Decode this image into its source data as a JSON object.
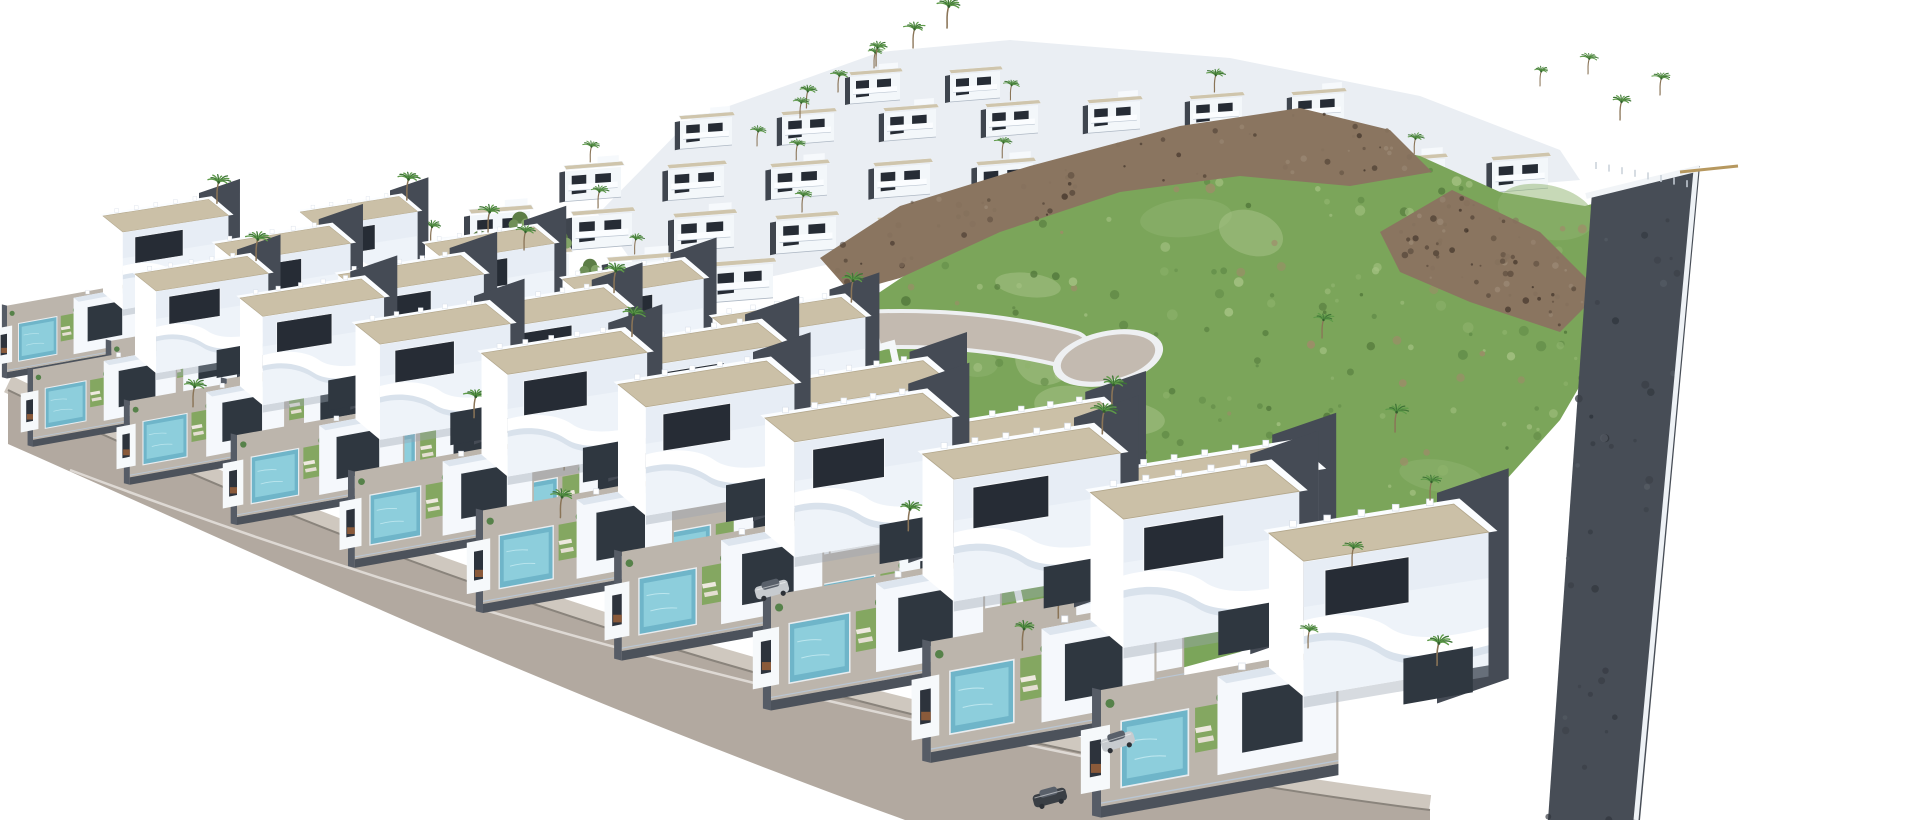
{
  "scene": {
    "description": "Aerial 3D render of a modern white villa resort development built on a slope: diagonal rows of cubic white villas with curved balconies, gravel flat roofs, private pools and palm trees; a dense cluster of terraced houses at the top; a green hillside with brown rocky outcrops on the right; a wide curved access road with sidewalk at the bottom left; no text visible in the image.",
    "seed": 11,
    "colors": {
      "background": "#ffffff",
      "villa_white": "#ffffff",
      "villa_face": "#eef3f9",
      "villa_face2": "#dde6f0",
      "villa_shade": "#c9d4e2",
      "roof_gravel": "#cbc0a7",
      "roof_edge": "#b3a78c",
      "window_dark": "#262c35",
      "glass_dark": "#2f3740",
      "terrace": "#bcb5ac",
      "pool": "#6fb5c9",
      "pool_light": "#93d2df",
      "lawn": "#84a761",
      "dark_wall": "#454b55",
      "fence_wall": "#565c66",
      "underlay": "#eaeef3",
      "hill_green": "#7ba55a",
      "hill_dark": "#53793c",
      "hill_light": "#a5c283",
      "soil": "#a08a6a",
      "rock_brown": "#8a7560",
      "rock_dark": "#5a4a3c",
      "rock_light": "#9c8a76",
      "palm_green": "#3e7436",
      "palm_green2": "#5d9a48",
      "trunk": "#8a7457",
      "tree_olive": "#6f8f57",
      "road": "#b2a9a0",
      "sidewalk": "#cfc8bf",
      "curb_line": "#8a847c",
      "white_line": "#eceae5",
      "inner_road": "#c3bab0",
      "inner_curb": "#eef0f2",
      "strip_dark": "#474d56",
      "car_silver": "#c7cbcf",
      "car_dark": "#3a3f45",
      "planter_orange": "#8a5a3a"
    },
    "road": {
      "top_path": "M8,390 C400,580 900,745 1430,810",
      "polygon": "M8,390 C400,580 900,745 1430,810 L1430,820 L905,820 C520,680 260,555 8,444 Z",
      "white_line": "M70,470 C480,625 800,700 1160,772"
    },
    "inner_road": {
      "path": "M862,330 C940,326 1010,334 1072,350",
      "bulb": [
        1108,
        358,
        56,
        27,
        -12
      ]
    },
    "hill": [
      [
        865,
        302
      ],
      [
        940,
        252
      ],
      [
        1060,
        200
      ],
      [
        1200,
        158
      ],
      [
        1330,
        136
      ],
      [
        1420,
        156
      ],
      [
        1500,
        192
      ],
      [
        1585,
        206
      ],
      [
        1668,
        182
      ],
      [
        1640,
        282
      ],
      [
        1560,
        420
      ],
      [
        1470,
        520
      ],
      [
        1360,
        592
      ],
      [
        1240,
        652
      ],
      [
        1130,
        682
      ],
      [
        1040,
        666
      ],
      [
        952,
        592
      ],
      [
        892,
        472
      ],
      [
        864,
        382
      ]
    ],
    "rocks": [
      [
        [
          820,
          258
        ],
        [
          900,
          206
        ],
        [
          1030,
          166
        ],
        [
          1180,
          126
        ],
        [
          1300,
          108
        ],
        [
          1390,
          130
        ],
        [
          1432,
          172
        ],
        [
          1350,
          186
        ],
        [
          1240,
          176
        ],
        [
          1120,
          192
        ],
        [
          1000,
          232
        ],
        [
          900,
          278
        ],
        [
          850,
          292
        ]
      ],
      [
        [
          1380,
          232
        ],
        [
          1452,
          190
        ],
        [
          1540,
          232
        ],
        [
          1600,
          292
        ],
        [
          1560,
          332
        ],
        [
          1470,
          302
        ],
        [
          1400,
          272
        ]
      ]
    ],
    "wall_steps": [
      [
        868,
        300
      ],
      [
        878,
        348
      ],
      [
        892,
        344
      ],
      [
        902,
        392
      ],
      [
        916,
        388
      ],
      [
        926,
        436
      ],
      [
        940,
        432
      ],
      [
        950,
        480
      ],
      [
        964,
        476
      ],
      [
        974,
        524
      ],
      [
        988,
        520
      ],
      [
        998,
        568
      ],
      [
        1012,
        564
      ],
      [
        1022,
        612
      ]
    ],
    "right_strip": [
      [
        1592,
        192
      ],
      [
        1700,
        166
      ],
      [
        1640,
        820
      ],
      [
        1548,
        820
      ]
    ],
    "underlay": [
      [
        598,
        214
      ],
      [
        690,
        120
      ],
      [
        880,
        52
      ],
      [
        1010,
        40
      ],
      [
        1230,
        58
      ],
      [
        1420,
        96
      ],
      [
        1560,
        150
      ],
      [
        1580,
        180
      ],
      [
        1340,
        200
      ],
      [
        1080,
        230
      ],
      [
        840,
        262
      ],
      [
        660,
        300
      ]
    ],
    "front_rows": [
      {
        "x": 300,
        "y": 212,
        "dx": 125,
        "dy": 32,
        "grow": 0.1,
        "n": 4,
        "s0": 0.6,
        "s1": 0.78
      },
      {
        "x": 103,
        "y": 216,
        "dx": 112,
        "dy": 28,
        "grow": 0.1,
        "n": 8,
        "s0": 0.64,
        "s1": 1.0
      },
      {
        "x": 135,
        "y": 274,
        "dx": 105,
        "dy": 24,
        "grow": 0.1,
        "n": 9,
        "s0": 0.68,
        "s1": 1.12
      }
    ],
    "back_rows": [
      {
        "x": 850,
        "y": 74,
        "dx": 100,
        "dy": -2,
        "n": 2,
        "s": 0.5
      },
      {
        "x": 680,
        "y": 118,
        "dx": 102,
        "dy": -4,
        "n": 7,
        "s": 0.52
      },
      {
        "x": 565,
        "y": 168,
        "dx": 103,
        "dy": -1,
        "n": 10,
        "s": 0.56
      },
      {
        "x": 470,
        "y": 212,
        "dx": 102,
        "dy": 2,
        "n": 5,
        "s": 0.6
      },
      {
        "x": 404,
        "y": 250,
        "dx": 102,
        "dy": 5,
        "n": 4,
        "s": 0.63
      }
    ],
    "palms": [
      [
        947,
        28,
        0.6
      ],
      [
        913,
        48,
        0.52
      ],
      [
        876,
        66,
        0.5
      ],
      [
        838,
        92,
        0.45
      ],
      [
        800,
        118,
        0.42
      ],
      [
        757,
        146,
        0.4
      ],
      [
        1620,
        120,
        0.5
      ],
      [
        1660,
        95,
        0.46
      ],
      [
        1588,
        74,
        0.42
      ],
      [
        1540,
        86,
        0.4
      ],
      [
        1395,
        432,
        0.55
      ],
      [
        1322,
        338,
        0.5
      ],
      [
        1352,
        566,
        0.5
      ],
      [
        1308,
        648,
        0.48
      ],
      [
        1430,
        500,
        0.5
      ],
      [
        488,
        232,
        0.55
      ],
      [
        524,
        250,
        0.5
      ]
    ],
    "trees": [
      [
        82,
        372
      ],
      [
        134,
        348
      ],
      [
        192,
        332
      ],
      [
        246,
        312
      ],
      [
        60,
        400
      ],
      [
        300,
        295
      ],
      [
        360,
        272
      ],
      [
        560,
        255
      ],
      [
        590,
        280
      ],
      [
        620,
        308
      ],
      [
        648,
        338
      ],
      [
        520,
        235
      ],
      [
        480,
        256
      ]
    ],
    "cars": [
      [
        1118,
        742,
        -17,
        "silver"
      ],
      [
        1050,
        798,
        -15,
        "dark"
      ],
      [
        772,
        590,
        -15,
        "silver"
      ]
    ],
    "corner": {
      "wall": [
        [
          1586,
          196
        ],
        [
          1700,
          168
        ]
      ],
      "beam": [
        [
          1680,
          172
        ],
        [
          1738,
          166
        ]
      ]
    },
    "scatter": {
      "hill_patches": 10,
      "hill_dots": 270,
      "rock_dots": 150,
      "strip_dots": 40
    },
    "counts": {
      "front_villas": 21,
      "back_houses": 28,
      "palm_trees": 50,
      "olive_trees": 13,
      "cars": 3,
      "pools": 21
    }
  }
}
